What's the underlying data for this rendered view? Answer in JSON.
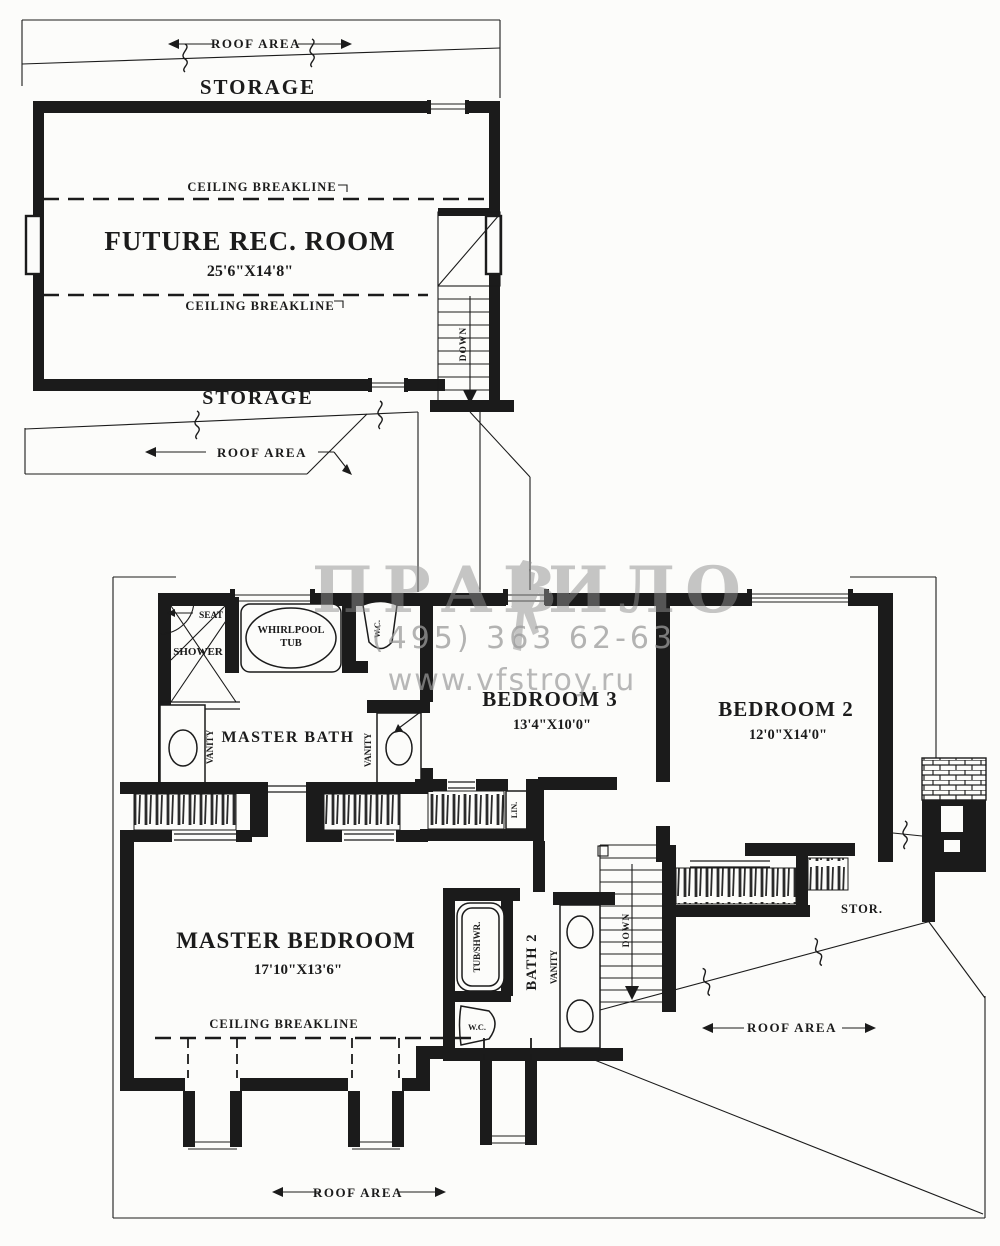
{
  "colors": {
    "ink": "#1b1b1b",
    "wm": "#8f8f8f",
    "bg": "#fcfcfa"
  },
  "upper": {
    "roof_area_top": "ROOF AREA",
    "storage_top": "STORAGE",
    "ceiling_breakline_1": "CEILING BREAKLINE",
    "room": "FUTURE REC. ROOM",
    "dims": "25'6\"X14'8\"",
    "ceiling_breakline_2": "CEILING BREAKLINE",
    "down": "DOWN",
    "storage_bottom": "STORAGE",
    "roof_area_bottom": "ROOF AREA"
  },
  "lower": {
    "seat": "SEAT",
    "shower": "SHOWER",
    "whirlpool_1": "WHIRLPOOL",
    "whirlpool_2": "TUB",
    "wc1": "W.C.",
    "master_bath": "MASTER BATH",
    "vanity_l": "VANITY",
    "vanity_r": "VANITY",
    "bedroom3": "BEDROOM 3",
    "bedroom3_dims": "13'4\"X10'0\"",
    "bedroom2": "BEDROOM 2",
    "bedroom2_dims": "12'0\"X14'0\"",
    "lin": "LIN.",
    "master_bedroom": "MASTER BEDROOM",
    "master_bedroom_dims": "17'10\"X13'6\"",
    "ceiling_breakline": "CEILING BREAKLINE",
    "tub_shwr": "TUB/SHWR.",
    "wc2": "W.C.",
    "bath2": "BATH 2",
    "vanity_b2": "VANITY",
    "down": "DOWN",
    "stor": "STOR.",
    "roof_area_right": "ROOF AREA",
    "roof_area_bottom": "ROOF AREA"
  },
  "watermark": {
    "logo_left": "ПРАВ",
    "logo_right": "ИЛО",
    "phone": "(495) 363 62-63",
    "url": "www.vfstroy.ru"
  }
}
